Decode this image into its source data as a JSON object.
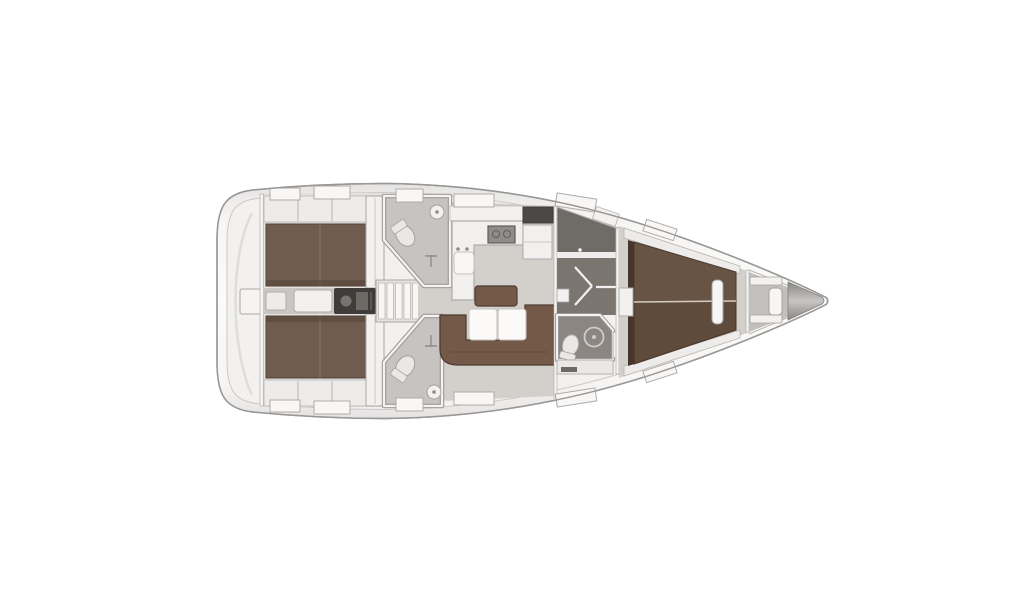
{
  "figure": {
    "title": "Sailing yacht interior deck plan, top view, bow pointing right",
    "orientation": "bow-right",
    "background": "#ffffff"
  },
  "colors": {
    "bg": "#ffffff",
    "hull_stroke": "#9a9896",
    "hull_edge": "#e4e3e2",
    "hull_mid": "#f6f5f4",
    "hull_center": "#fbfbfa",
    "deck_inner": "#f2f1f0",
    "deck_inner_line": "#cbc9c7",
    "arc_line": "#dedddb",
    "wall_fill": "#f5f4f3",
    "wall_stroke": "#a9a7a5",
    "floor_salon": "#d3d0cc",
    "floor_cabin": "#e4e2df",
    "floor_corridor": "#c9c6c3",
    "shelf_fill": "#edecea",
    "shelf_stroke": "#b6b4b2",
    "berth_aft": "#6f5b4f",
    "berth_aft_edge": "#55433a",
    "berth_aft_seam": "#8a7261",
    "berth_fwd": "#5f4b3c",
    "berth_fwd_edge": "#46352a",
    "berth_fwd_seam": "#d5ccc1",
    "settee": "#755948",
    "settee_edge": "#4e3b31",
    "settee_seam": "#63493c",
    "table_fill": "#fbfaf9",
    "table_stroke": "#c6c3c0",
    "head_floor": "#c6c3c0",
    "head_wall_outer": "#9e9c9a",
    "head_wall_inner": "#f4f3f2",
    "fixture_fill": "#eae8e6",
    "fixture_stroke": "#a3a1a0",
    "counter_fill": "#f1f0ee",
    "counter_stroke": "#aeacaa",
    "stove_fill": "#8f8d8a",
    "stove_stroke": "#5f5d5a",
    "dark_cabinet": "#4b4947",
    "engine_dark": "#3f3d3b",
    "engine_part": "#77756f",
    "box_fill": "#f2f1ef",
    "steps_frame": "#e4e3e1",
    "step_tread": "#f7f6f5",
    "step_stroke": "#b5b3b1",
    "wardrobe_floor": "#6f6b67",
    "passage_floor": "#7b7570",
    "fwdhead_floor": "#8b8681",
    "door_line": "#f2f1ef",
    "shower_ring": "#cfcdcb",
    "locker_floor": "#c2c0bd",
    "bow_dark": "#838180",
    "bow_light": "#c7c6c4",
    "hatch_fill": "#f8f7f6",
    "hatch_stroke": "#aeacaa"
  },
  "areas": [
    {
      "id": "swim-platform",
      "label": "Stern swim platform"
    },
    {
      "id": "aft-cabin-port",
      "label": "Aft cabin port with double berth"
    },
    {
      "id": "aft-cabin-starboard",
      "label": "Aft cabin starboard with double berth"
    },
    {
      "id": "engine-compartment",
      "label": "Engine compartment under companionway"
    },
    {
      "id": "companionway-steps",
      "label": "Companionway steps"
    },
    {
      "id": "aft-head-port",
      "label": "Aft head port with toilet and washbasin"
    },
    {
      "id": "aft-head-starboard",
      "label": "Aft head starboard with toilet and washbasin"
    },
    {
      "id": "galley",
      "label": "L-shaped galley with sink and stove"
    },
    {
      "id": "salon",
      "label": "Salon with U-shaped settee, bench and folding table"
    },
    {
      "id": "wardrobe",
      "label": "Wardrobe locker"
    },
    {
      "id": "passageway",
      "label": "Passageway with doors"
    },
    {
      "id": "forward-head",
      "label": "Forward head with toilet and shower"
    },
    {
      "id": "forward-cabin",
      "label": "Forward cabin with V-berth"
    },
    {
      "id": "anchor-locker",
      "label": "Anchor locker with ladder rungs"
    },
    {
      "id": "bow",
      "label": "Bow tip"
    }
  ]
}
